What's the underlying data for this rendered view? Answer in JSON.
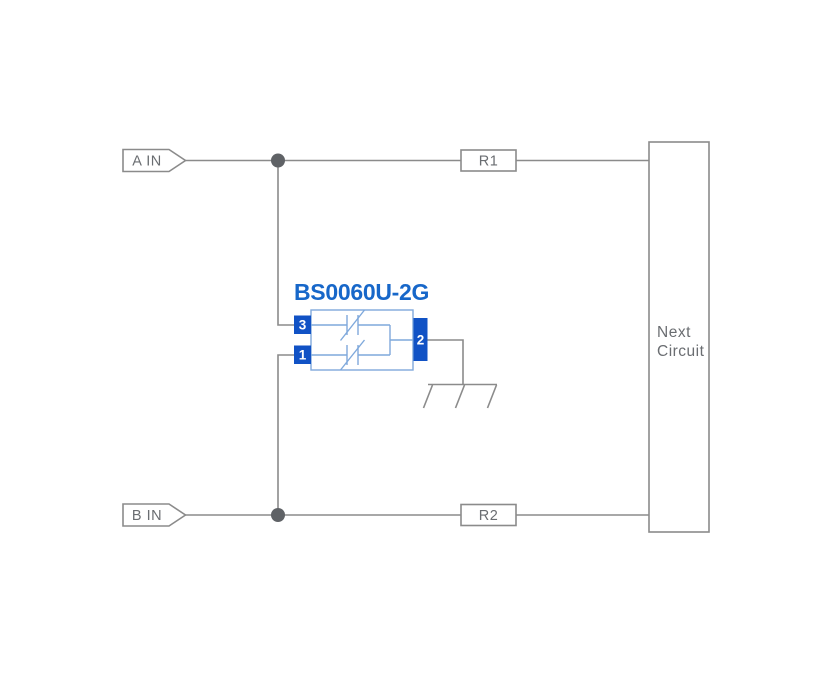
{
  "colors": {
    "background": "#ffffff",
    "wire": "#8b8b8b",
    "label_text": "#6a6d71",
    "junction": "#5f6266",
    "pin_blue": "#1152c5",
    "title_blue": "#1767c9",
    "body_blue": "#7fa9dc",
    "pin_text": "#ffffff"
  },
  "inputs": {
    "a": "A IN",
    "b": "B IN"
  },
  "resistors": {
    "r1": "R1",
    "r2": "R2"
  },
  "component": {
    "title": "BS0060U-2G",
    "pin3": "3",
    "pin1": "1",
    "pin2": "2"
  },
  "next_circuit": {
    "line1": "Next",
    "line2": "Circuit"
  }
}
